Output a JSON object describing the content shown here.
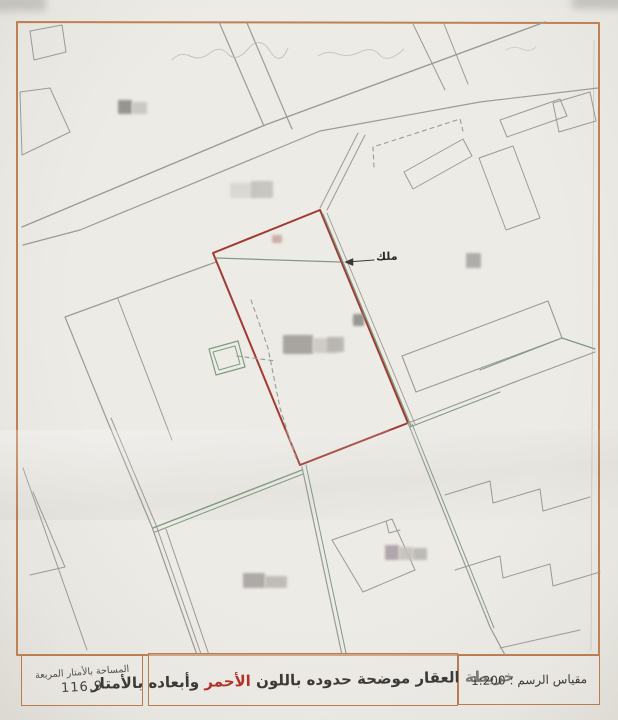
{
  "map": {
    "owner_label": "ملك",
    "scale_text": "1:200",
    "area_value": "116.9"
  },
  "legend": {
    "area_box": {
      "title": "المساحة بالأمتار المربعة",
      "value": "116.9"
    },
    "title_box": {
      "text_before": "خريطة العقار موضحة حدوده باللون",
      "red_word": "الأحمر",
      "text_after": "وأبعاده بالأمتار"
    },
    "scale_box": {
      "label": "مقياس الرسم :",
      "value": "1:200"
    }
  },
  "colors": {
    "frame": "#bf8054",
    "gray": "#9b9a96",
    "green": "#7f9b80",
    "red": "#a03a32",
    "dark": "#3a3836",
    "faint": "#b8b5ac"
  },
  "map_geometry": {
    "elements": [
      {
        "name": "map-frame",
        "kind": "polygon",
        "pts": "17,22 599,23 599,655 17,655",
        "color": "frame",
        "w": 2
      },
      {
        "name": "street-upper-line",
        "kind": "polyline",
        "pts": "545,22 265,125 22,227",
        "color": "gray",
        "w": 1.4
      },
      {
        "name": "street-lower-line",
        "kind": "polyline",
        "pts": "598,88 480,102 320,131 80,230 23,245",
        "color": "gray",
        "w": 1.2
      },
      {
        "name": "lane-north-a",
        "kind": "polyline",
        "pts": "219,22 264,126",
        "color": "gray",
        "w": 1.2
      },
      {
        "name": "lane-north-b",
        "kind": "polyline",
        "pts": "247,23 292,129",
        "color": "gray",
        "w": 1.2
      },
      {
        "name": "lane-northeast-a",
        "kind": "polyline",
        "pts": "413,24 445,90",
        "color": "gray",
        "w": 1
      },
      {
        "name": "lane-northeast-b",
        "kind": "polyline",
        "pts": "444,24 468,84",
        "color": "gray",
        "w": 1
      },
      {
        "name": "parcel-northwest-1",
        "kind": "polygon",
        "pts": "30,31 62,25 66,52 34,60",
        "color": "gray",
        "w": 1
      },
      {
        "name": "parcel-northwest-2",
        "kind": "polygon",
        "pts": "20,92 50,88 70,132 22,155",
        "color": "gray",
        "w": 1
      },
      {
        "name": "parcel-west-outline",
        "kind": "polyline",
        "pts": "216,262 65,317 107,420",
        "color": "gray",
        "w": 1.2
      },
      {
        "name": "boundary-southwest-1",
        "kind": "polyline",
        "pts": "107,420 152,527 197,655",
        "color": "gray",
        "w": 1.2
      },
      {
        "name": "boundary-southwest-2",
        "kind": "polyline",
        "pts": "111,418 156,525 201,654",
        "color": "gray",
        "w": 1
      },
      {
        "name": "lane-southwest",
        "kind": "polyline",
        "pts": "166,529 209,655",
        "color": "gray",
        "w": 1
      },
      {
        "name": "parcel-west-inner-line",
        "kind": "polyline",
        "pts": "118,299 172,440",
        "color": "gray",
        "w": 1
      },
      {
        "name": "boundary-green-south-1",
        "kind": "polyline",
        "pts": "153,528 302,470",
        "color": "green",
        "w": 1.4
      },
      {
        "name": "boundary-green-south-2",
        "kind": "polyline",
        "pts": "155,532 303,474",
        "color": "green",
        "w": 1
      },
      {
        "name": "boundary-below-red",
        "kind": "polyline",
        "pts": "302,467 342,655",
        "color": "gray",
        "w": 1.2
      },
      {
        "name": "boundary-below-red-green",
        "kind": "polyline",
        "pts": "306,465 346,653",
        "color": "green",
        "w": 1
      },
      {
        "name": "red-parcel",
        "kind": "polygon",
        "pts": "213,253 320,210 408,423 300,465",
        "color": "red",
        "w": 2
      },
      {
        "name": "red-parcel-green-east",
        "kind": "polyline",
        "pts": "323,214 411,426",
        "color": "green",
        "w": 1.2
      },
      {
        "name": "red-parcel-gray-east",
        "kind": "polyline",
        "pts": "327,213 415,424",
        "color": "gray",
        "w": 0.9
      },
      {
        "name": "green-inner-top",
        "kind": "polyline",
        "pts": "216,258 340,262",
        "color": "green",
        "w": 1.2
      },
      {
        "name": "dashed-inner-boundary",
        "kind": "polyline",
        "pts": "251,300 268,348 280,408 296,458",
        "color": "gray",
        "w": 1.1,
        "dash": "4 4"
      },
      {
        "name": "dashed-inner-spur",
        "kind": "polyline",
        "pts": "237,356 276,361",
        "color": "gray",
        "w": 1.1,
        "dash": "4 4"
      },
      {
        "name": "green-annex-outer",
        "kind": "polygon",
        "pts": "209,349 238,341 245,367 216,375",
        "color": "green",
        "w": 1.2
      },
      {
        "name": "green-annex-inner",
        "kind": "polygon",
        "pts": "213,352 235,346 240,364 219,370",
        "color": "green",
        "w": 1
      },
      {
        "name": "neighbor-north-a",
        "kind": "polyline",
        "pts": "320,208 358,133",
        "color": "gray",
        "w": 1
      },
      {
        "name": "neighbor-north-b",
        "kind": "polyline",
        "pts": "327,210 365,135",
        "color": "gray",
        "w": 1
      },
      {
        "name": "dashed-parcel-north",
        "kind": "polyline",
        "pts": "374,167 373,147 460,119 463,131",
        "color": "gray",
        "w": 1.1,
        "dash": "4 4"
      },
      {
        "name": "slab-north",
        "kind": "polygon",
        "pts": "404,172 463,139 472,156 413,189",
        "color": "gray",
        "w": 1
      },
      {
        "name": "slab-northeast-1",
        "kind": "polygon",
        "pts": "500,120 560,99 567,116 507,137",
        "color": "gray",
        "w": 1
      },
      {
        "name": "slab-northeast-2",
        "kind": "polygon",
        "pts": "479,158 513,146 540,218 506,230",
        "color": "gray",
        "w": 1
      },
      {
        "name": "slab-northeast-3",
        "kind": "polygon",
        "pts": "553,103 590,92 596,121 559,132",
        "color": "gray",
        "w": 1
      },
      {
        "name": "boundary-east-1",
        "kind": "polyline",
        "pts": "408,423 520,380 595,352",
        "color": "gray",
        "w": 1.2
      },
      {
        "name": "boundary-east-green",
        "kind": "polyline",
        "pts": "410,427 500,392",
        "color": "green",
        "w": 1
      },
      {
        "name": "boundary-east-green-2",
        "kind": "polyline",
        "pts": "562,338 595,349",
        "color": "green",
        "w": 1.2
      },
      {
        "name": "slab-east",
        "kind": "polygon",
        "pts": "402,356 548,301 562,338 416,392",
        "color": "gray",
        "w": 1.1
      },
      {
        "name": "slab-east-green-edge",
        "kind": "polyline",
        "pts": "480,370 562,338",
        "color": "green",
        "w": 1
      },
      {
        "name": "boundary-southeast",
        "kind": "polyline",
        "pts": "408,423 490,627 505,655",
        "color": "gray",
        "w": 1.2
      },
      {
        "name": "boundary-southeast-green",
        "kind": "polyline",
        "pts": "412,424 494,628",
        "color": "green",
        "w": 1
      },
      {
        "name": "stepped-buildings-a",
        "kind": "polyline",
        "pts": "445,495 490,481 493,503 540,489 543,511 590,497",
        "color": "gray",
        "w": 1
      },
      {
        "name": "stepped-buildings-b",
        "kind": "polyline",
        "pts": "455,570 500,556 503,578 550,564 553,586 600,572",
        "color": "gray",
        "w": 1
      },
      {
        "name": "building-south",
        "kind": "polygon",
        "pts": "332,540 392,519 415,570 363,592",
        "color": "gray",
        "w": 1
      },
      {
        "name": "building-south-notch",
        "kind": "polyline",
        "pts": "386,521 389,533 400,530",
        "color": "gray",
        "w": 1
      },
      {
        "name": "boundary-bottom-right",
        "kind": "polyline",
        "pts": "500,648 580,630",
        "color": "gray",
        "w": 1
      },
      {
        "name": "parcel-bottomleft-edge",
        "kind": "polyline",
        "pts": "23,468 87,650",
        "color": "gray",
        "w": 1
      },
      {
        "name": "parcel-bottomleft-a",
        "kind": "polyline",
        "pts": "33,492 65,567",
        "color": "gray",
        "w": 1
      },
      {
        "name": "parcel-bottomleft-b",
        "kind": "polyline",
        "pts": "30,575 65,567",
        "color": "gray",
        "w": 1
      },
      {
        "name": "frame-inner-right",
        "kind": "polyline",
        "pts": "594,40 591,650",
        "color": "gray",
        "w": 0.7,
        "op": 0.5
      },
      {
        "name": "owner-arrow-line",
        "kind": "polyline",
        "pts": "347,262 374,260",
        "color": "dark",
        "w": 1
      },
      {
        "name": "owner-arrow-head",
        "kind": "polygon",
        "pts": "345,262 353,258.5 353,265.5",
        "color": "dark",
        "w": 0.5,
        "fill": "#3a3836"
      },
      {
        "name": "handwriting-top-1",
        "kind": "path",
        "d": "M172,60 q8,-9 18,-4 t20,-3 t18,1 t20,-5 t22,2 t18,-3",
        "color": "faint",
        "w": 1,
        "op": 0.7
      },
      {
        "name": "handwriting-top-2",
        "kind": "path",
        "d": "M318,56 q10,-6 20,-2 t22,-2 t20,3 t24,-6",
        "color": "faint",
        "w": 1,
        "op": 0.65
      },
      {
        "name": "handwriting-top-3",
        "kind": "path",
        "d": "M506,50 q8,-5 16,-1 t14,-2",
        "color": "faint",
        "w": 1,
        "op": 0.5
      }
    ],
    "blurs": [
      {
        "name": "redaction-blur-nw-dark",
        "x": 118,
        "y": 100,
        "w": 14,
        "h": 14,
        "c": "#8e8c88"
      },
      {
        "name": "redaction-blur-nw-light",
        "x": 132,
        "y": 102,
        "w": 15,
        "h": 12,
        "c": "#c8c6c1"
      },
      {
        "name": "redaction-blur-n-1",
        "x": 230,
        "y": 183,
        "w": 26,
        "h": 15,
        "c": "#d8d6d1"
      },
      {
        "name": "redaction-blur-n-2",
        "x": 251,
        "y": 181,
        "w": 22,
        "h": 17,
        "c": "#c4c2bd"
      },
      {
        "name": "redaction-blur-east",
        "x": 466,
        "y": 253,
        "w": 15,
        "h": 15,
        "c": "#a9a7a3"
      },
      {
        "name": "redaction-mark-red-parcel",
        "x": 272,
        "y": 235,
        "w": 10,
        "h": 8,
        "c": "#c9a8a0"
      },
      {
        "name": "redaction-blur-center-1",
        "x": 283,
        "y": 335,
        "w": 30,
        "h": 19,
        "c": "#a19d98"
      },
      {
        "name": "redaction-blur-center-2",
        "x": 313,
        "y": 338,
        "w": 25,
        "h": 15,
        "c": "#ccc9c4"
      },
      {
        "name": "redaction-blur-center-3",
        "x": 327,
        "y": 337,
        "w": 17,
        "h": 15,
        "c": "#b7b4af"
      },
      {
        "name": "redaction-wedge-center",
        "x": 353,
        "y": 314,
        "w": 11,
        "h": 12,
        "c": "#908e8a"
      },
      {
        "name": "redaction-blur-south-1",
        "x": 385,
        "y": 545,
        "w": 14,
        "h": 15,
        "c": "#ab9fa5"
      },
      {
        "name": "redaction-blur-south-2",
        "x": 399,
        "y": 547,
        "w": 14,
        "h": 13,
        "c": "#c3c0bb"
      },
      {
        "name": "redaction-blur-south-3",
        "x": 413,
        "y": 548,
        "w": 14,
        "h": 12,
        "c": "#b9b6b1"
      },
      {
        "name": "redaction-blur-sw-1",
        "x": 243,
        "y": 573,
        "w": 22,
        "h": 15,
        "c": "#a8a3a1"
      },
      {
        "name": "redaction-blur-sw-2",
        "x": 265,
        "y": 576,
        "w": 22,
        "h": 12,
        "c": "#bcb9b4"
      }
    ]
  }
}
